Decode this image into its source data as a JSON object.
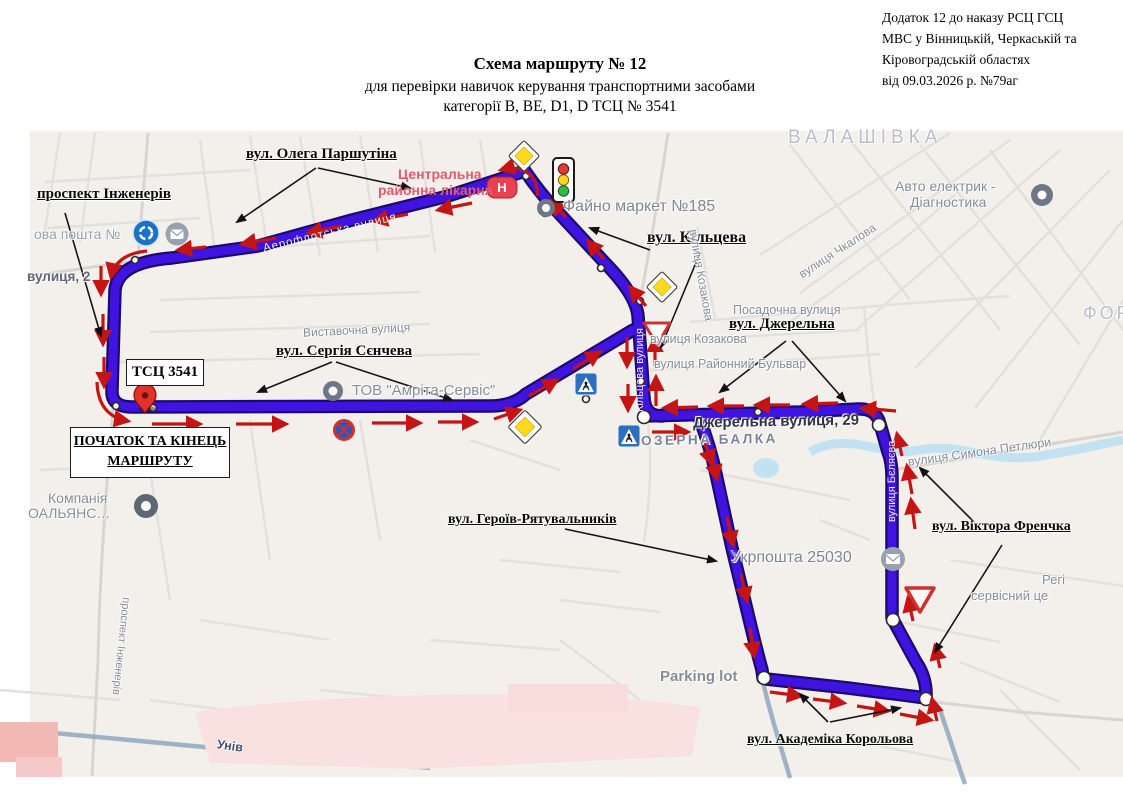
{
  "header": {
    "title_line1": "Схема маршруту № 12",
    "title_line2": "для перевірки навичок керування транспортними засобами",
    "title_line3": "категорії В, ВЕ, D1, D  ТСЦ № 3541"
  },
  "annex": {
    "line1": "Додаток 12 до наказу РСЦ ГСЦ",
    "line2": "МВС у Вінницькій, Черкаській та",
    "line3": "Кіровоградській областях",
    "line4": "від 09.03.2026 р. №79аг"
  },
  "callouts": {
    "prospekt": "проспект Інженерів",
    "parshutina": "вул. Олега Паршутіна",
    "kiltseva": "вул. Кільцева",
    "dzherelna": "вул. Джерельна",
    "sencheva": "вул. Сергія Сєнчева",
    "heroiv": "вул. Героїв-Рятувальників",
    "frenchka": "вул. Віктора Френчка",
    "korolova": "вул. Академіка Корольова"
  },
  "boxes": {
    "tsc": "ТСЦ 3541",
    "start1": "ПОЧАТОК ТА КІНЕЦЬ",
    "start2": "МАРШРУТУ"
  },
  "map_labels": {
    "nova_poshta": "ова пошта №",
    "vul2": "вулиця, 2",
    "hosp1": "Центральна",
    "hosp2": "районна лікарня",
    "hosp_h": "Н",
    "fayno": "Файно маркет №185",
    "valashivka": "ВАЛАШІВКА",
    "avto1": "Авто електрик -",
    "avto2": "Діагностика",
    "chkalova": "вулиця Чкалова",
    "posadochna": "Посадочна вулиця",
    "kozakova": "вулиця Козакова",
    "kozakova2": "вулиця Козакова",
    "rayonny": "вулиця Районний Бульвар",
    "vystavochna": "Виставочна вулиця",
    "tov": "ТОВ \"Амріта-Сервіс\"",
    "ozerna": "ОЗЕРНА БАЛКА",
    "dzherelna29": "Джерельна вулиця, 29",
    "petliury": "вулиця Симона Петлюри",
    "ukrposhta": "Укрпошта 25030",
    "parking": "Parking lot",
    "kompania": "Компанія",
    "alians": "ОАЛЬЯНС…",
    "rehi": "Регі",
    "servis": "сервісний це",
    "fort": "ФОР",
    "prospekt_st": "проспект Інженерів",
    "univ": "Унів",
    "kiltseva_st": "Кільцева вулиця",
    "bieliaieva_st": "вулиця Бєляєва",
    "aeroflotska_st": "Аерофлотська вулиця"
  },
  "legend": {
    "route_color": "#4014e0",
    "route_border_color": "#1c096e",
    "arrow_color": "#c41414",
    "priority_sign_color": "#ffd91e",
    "signs": [
      "priority-road-sign",
      "traffic-light",
      "yield-sign",
      "no-stopping-sign",
      "pedestrian-crossing-sign",
      "roundabout-sign",
      "hospital-poi",
      "post-office-poi",
      "route-start-pin"
    ]
  }
}
